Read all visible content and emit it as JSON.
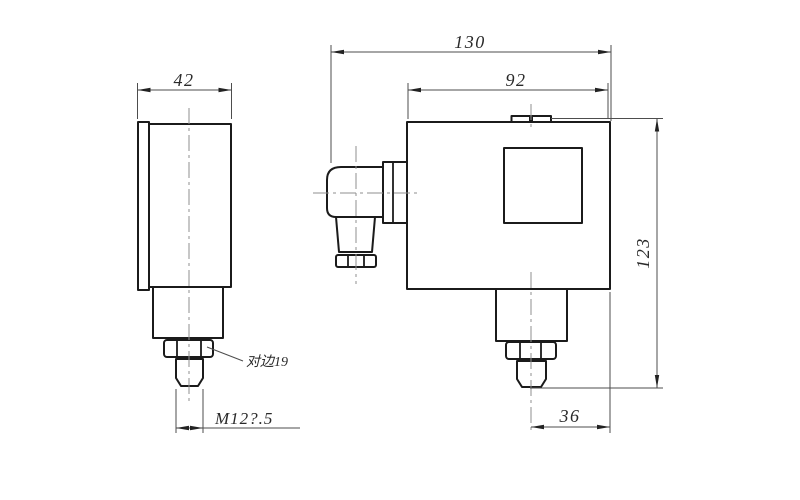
{
  "labels": {
    "front_width": "42",
    "overall_width": "130",
    "body_width": "92",
    "overall_height": "123",
    "port_offset": "36",
    "thread_spec": "M12?.5",
    "across_flats": "对边19"
  },
  "colors": {
    "background": "#ffffff",
    "outline": "#1b1b1b",
    "dim_line": "#4d4d4d",
    "centerline": "#8f8f8f",
    "dim_text": "#2a2a2a"
  }
}
